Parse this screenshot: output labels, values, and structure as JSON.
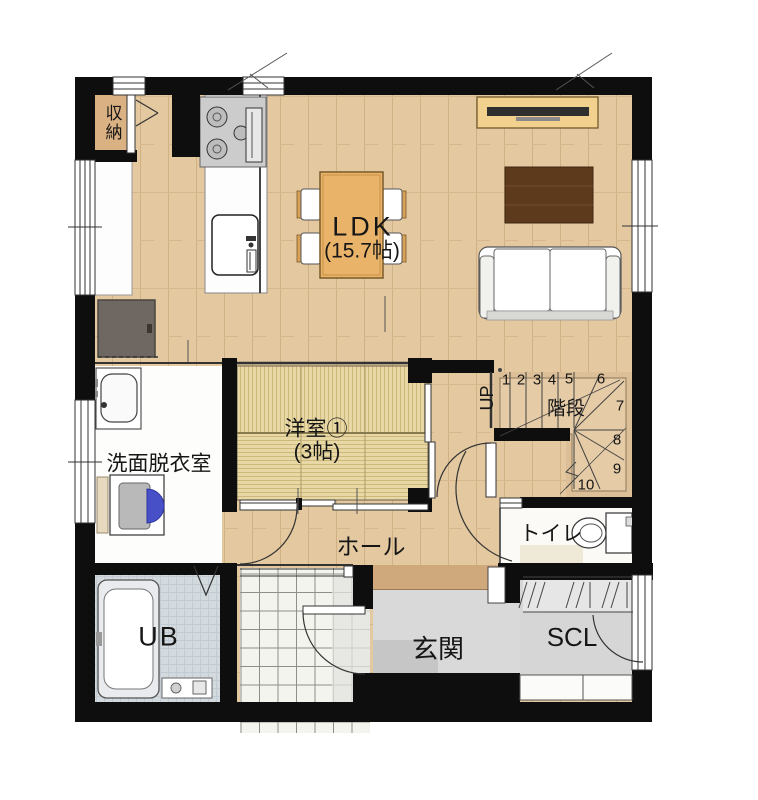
{
  "plan_type": "floor-plan",
  "colors": {
    "wall": "#0e0e0e",
    "wood_floor": "#e3c8a0",
    "tatami_floor": "#e7d8a6",
    "stair_floor": "#dcbe97",
    "porch_tile": "#f4f4ef",
    "bath_floor": "#d3dade",
    "entry_floor": "#d9d9d9",
    "furniture_wood": "#e9b469",
    "rug_brown": "#5e3a1d",
    "washer_blue": "#4850c8"
  },
  "rooms": {
    "storage": {
      "label": "収納"
    },
    "ldk": {
      "label": "LDK",
      "size": "(15.7帖)"
    },
    "washroom": {
      "label": "洗面脱衣室"
    },
    "western_room": {
      "label": "洋室①",
      "size": "(3帖)"
    },
    "hall": {
      "label": "ホール"
    },
    "stairs": {
      "label": "階段",
      "direction": "UP",
      "steps": [
        "1",
        "2",
        "3",
        "4",
        "5",
        "6",
        "7",
        "8",
        "9",
        "10"
      ]
    },
    "toilet": {
      "label": "トイレ"
    },
    "unit_bath": {
      "label": "UB"
    },
    "entrance": {
      "label": "玄関"
    },
    "shoe_closet": {
      "label": "SCL"
    }
  }
}
